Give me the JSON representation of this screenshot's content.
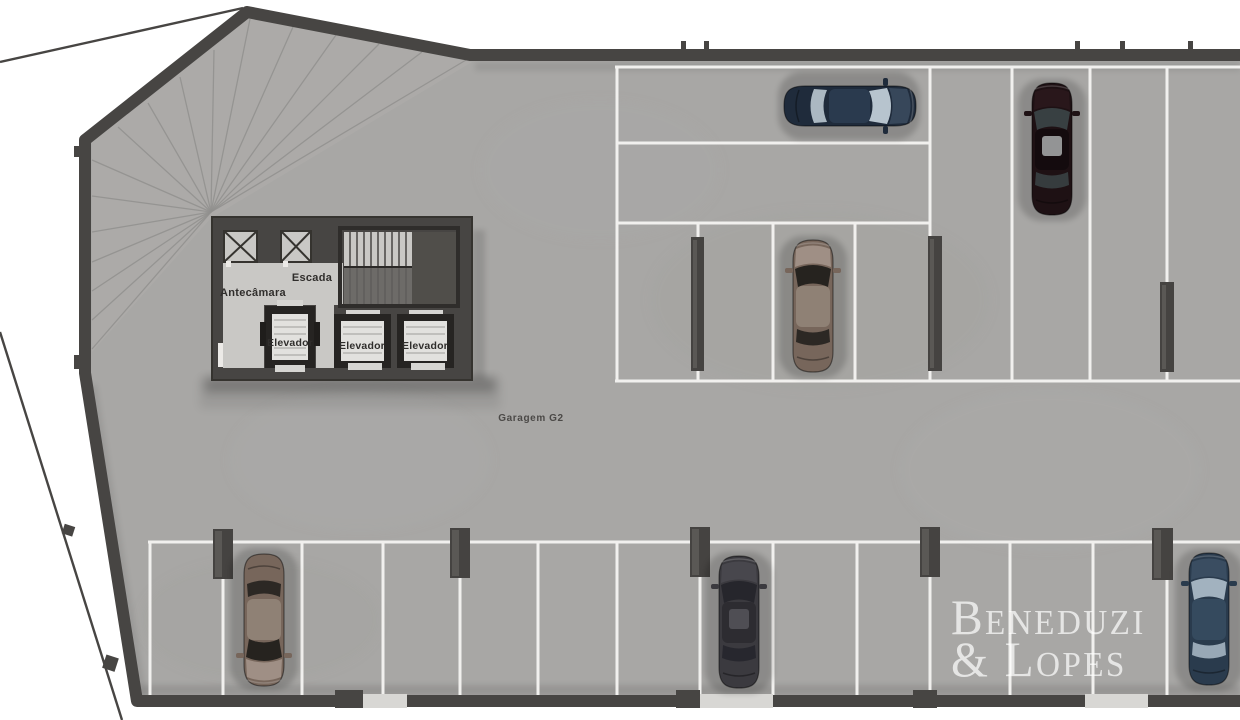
{
  "plan": {
    "floor_name": "Garagem G2",
    "labels": {
      "garage": "Garagem G2",
      "stairs": "Escada",
      "antechamber": "Antecâmara",
      "elevator1": "Elevador",
      "elevator2": "Elevador",
      "elevator3": "Elevador"
    },
    "watermark": {
      "line1": "Beneduzi",
      "line2": "& Lopes"
    },
    "palette": {
      "background": "#ffffff",
      "floor": "#a8a7a5",
      "ramp_floor": "#b1b0ae",
      "core_floor": "#c9c8c5",
      "wall": "#474543",
      "wall_dark": "#35332f",
      "wall_gap": "#d8d7d4",
      "parking_line": "#f1f0ee",
      "ramp_line": "#91908e",
      "pillar": "#454341",
      "pillar_light": "#615f5c",
      "lift_frame": "#262422",
      "lift_cab": "#e2e1de",
      "label_dark": "#302e2c",
      "label_medium": "#4b4947",
      "watermark_color": "rgba(255,255,255,0.70)"
    },
    "cars": {
      "blue_sedan_top": {
        "body": "#1f2b3b",
        "hood": "#3a4a5e",
        "glass": "#b7c4ce",
        "roof": "#2a3a4e"
      },
      "maroon_sedan": {
        "body": "#1e1114",
        "hood": "#2a181c",
        "glass": "#384042",
        "roof": "#140b0e",
        "sunroof": "#a9adad"
      },
      "brown_suv_upper": {
        "body": "#77665b",
        "hood": "#a3948a",
        "glass": "#26231f",
        "roof": "#8f8175"
      },
      "brown_suv_lower": {
        "body": "#77665b",
        "hood": "#a3948a",
        "glass": "#26231f",
        "roof": "#8f8175"
      },
      "charcoal_sedan": {
        "body": "#3b3a3f",
        "hood": "#4a494f",
        "glass": "#26262c",
        "roof": "#2d2c31",
        "sunroof": "#56555b"
      },
      "steel_blue_sedan": {
        "body": "#2a3b4d",
        "hood": "#3c5064",
        "glass": "#a2b2bf",
        "roof": "#354a5e"
      }
    }
  }
}
